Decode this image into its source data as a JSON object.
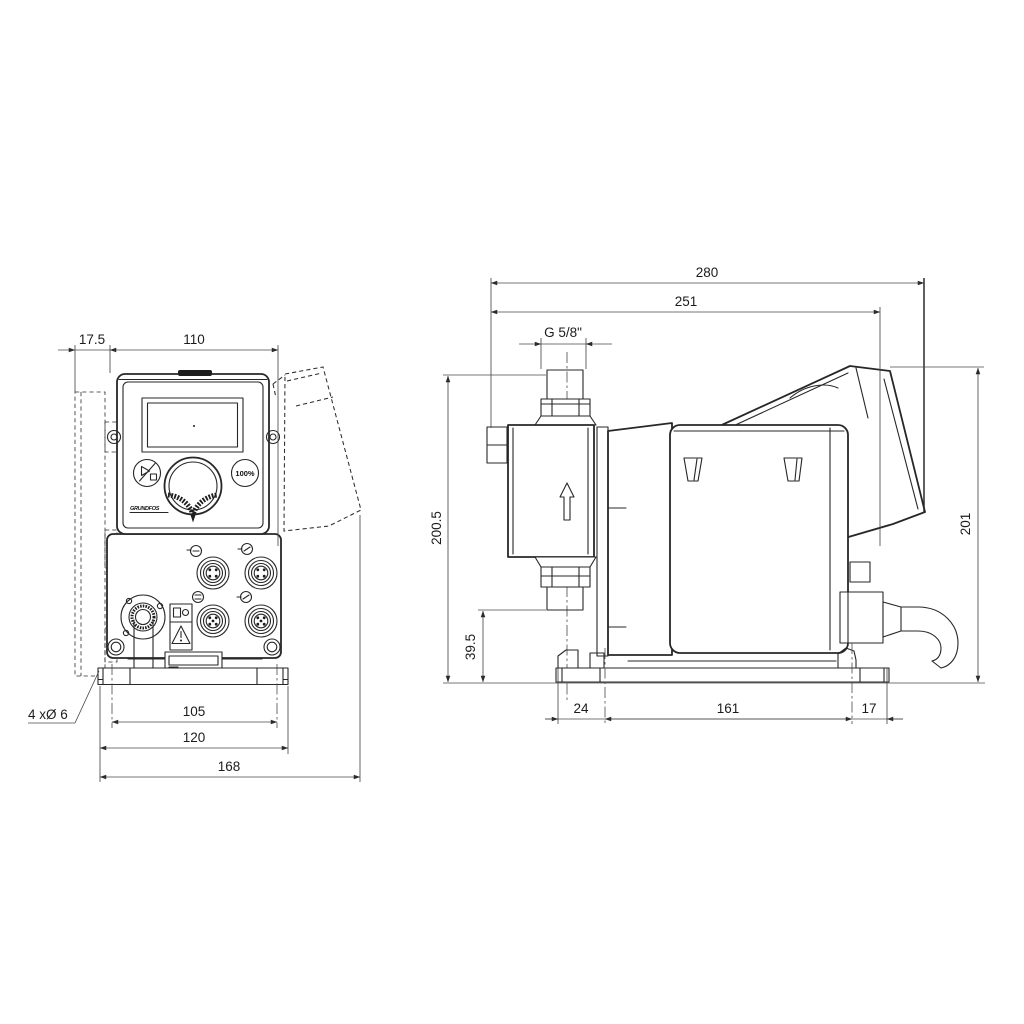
{
  "front_view": {
    "dims": {
      "offset": "17.5",
      "width": "110",
      "hole_spacing": "105",
      "plate_width": "120",
      "overall_width": "168"
    },
    "holes_label": "4 xØ 6",
    "controls": {
      "boost_button": "100%",
      "logo": "GRUNDFOS"
    }
  },
  "side_view": {
    "dims": {
      "overall_depth": "280",
      "cover_depth": "251",
      "thread": "G 5/8\"",
      "discharge_height": "200.5",
      "suction_height": "39.5",
      "base_front": "24",
      "hole_spacing": "161",
      "base_rear": "17",
      "overall_height": "201"
    }
  },
  "colors": {
    "background": "#ffffff",
    "line": "#272727",
    "dimension": "#4a4a4a",
    "text": "#1c1c1c"
  }
}
